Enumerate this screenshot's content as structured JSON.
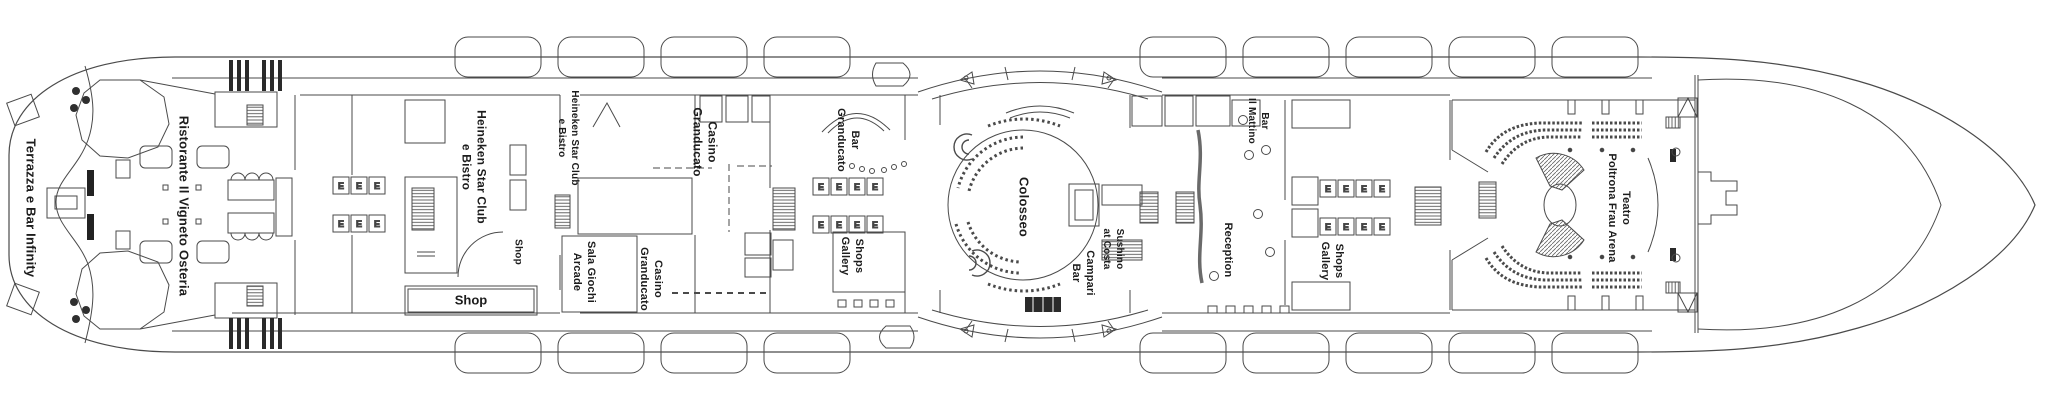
{
  "diagram": {
    "type": "cruise-ship-deck-plan",
    "line_color": "#4a4a4a",
    "background": "#ffffff",
    "elevator_symbol": "E"
  },
  "venues": {
    "terrazza": {
      "label": "Terrazza e Bar Infinity"
    },
    "ristorante": {
      "label": "Ristorante Il Vigneto Osteria"
    },
    "heineken_main": {
      "line1": "Heineken Star Club",
      "line2": "e Bistro"
    },
    "heineken_small": {
      "line1": "Heineken Star Club",
      "line2": "e Bistro"
    },
    "shop_small": {
      "label": "Shop"
    },
    "shop_box": {
      "label": "Shop"
    },
    "sala_giochi": {
      "line1": "Sala Giochi",
      "line2": "Arcade"
    },
    "casino_upper": {
      "line1": "Casino",
      "line2": "Granducato"
    },
    "casino_lower": {
      "line1": "Casino",
      "line2": "Granducato"
    },
    "bar_granducato": {
      "line1": "Bar",
      "line2": "Granducato"
    },
    "shops_gallery_mid": {
      "line1": "Shops",
      "line2": "Gallery"
    },
    "colosseo": {
      "label": "Colosseo"
    },
    "campari_bar": {
      "line1": "Campari",
      "line2": "Bar"
    },
    "sushino": {
      "line1": "Sushino",
      "line2": "at Costa"
    },
    "reception": {
      "label": "Reception"
    },
    "bar_il_mattino": {
      "line1": "Bar",
      "line2": "Il Mattino"
    },
    "shops_gallery_fwd": {
      "line1": "Shops",
      "line2": "Gallery"
    },
    "teatro": {
      "line1": "Teatro",
      "line2": "Poltrona Frau Arena"
    }
  }
}
